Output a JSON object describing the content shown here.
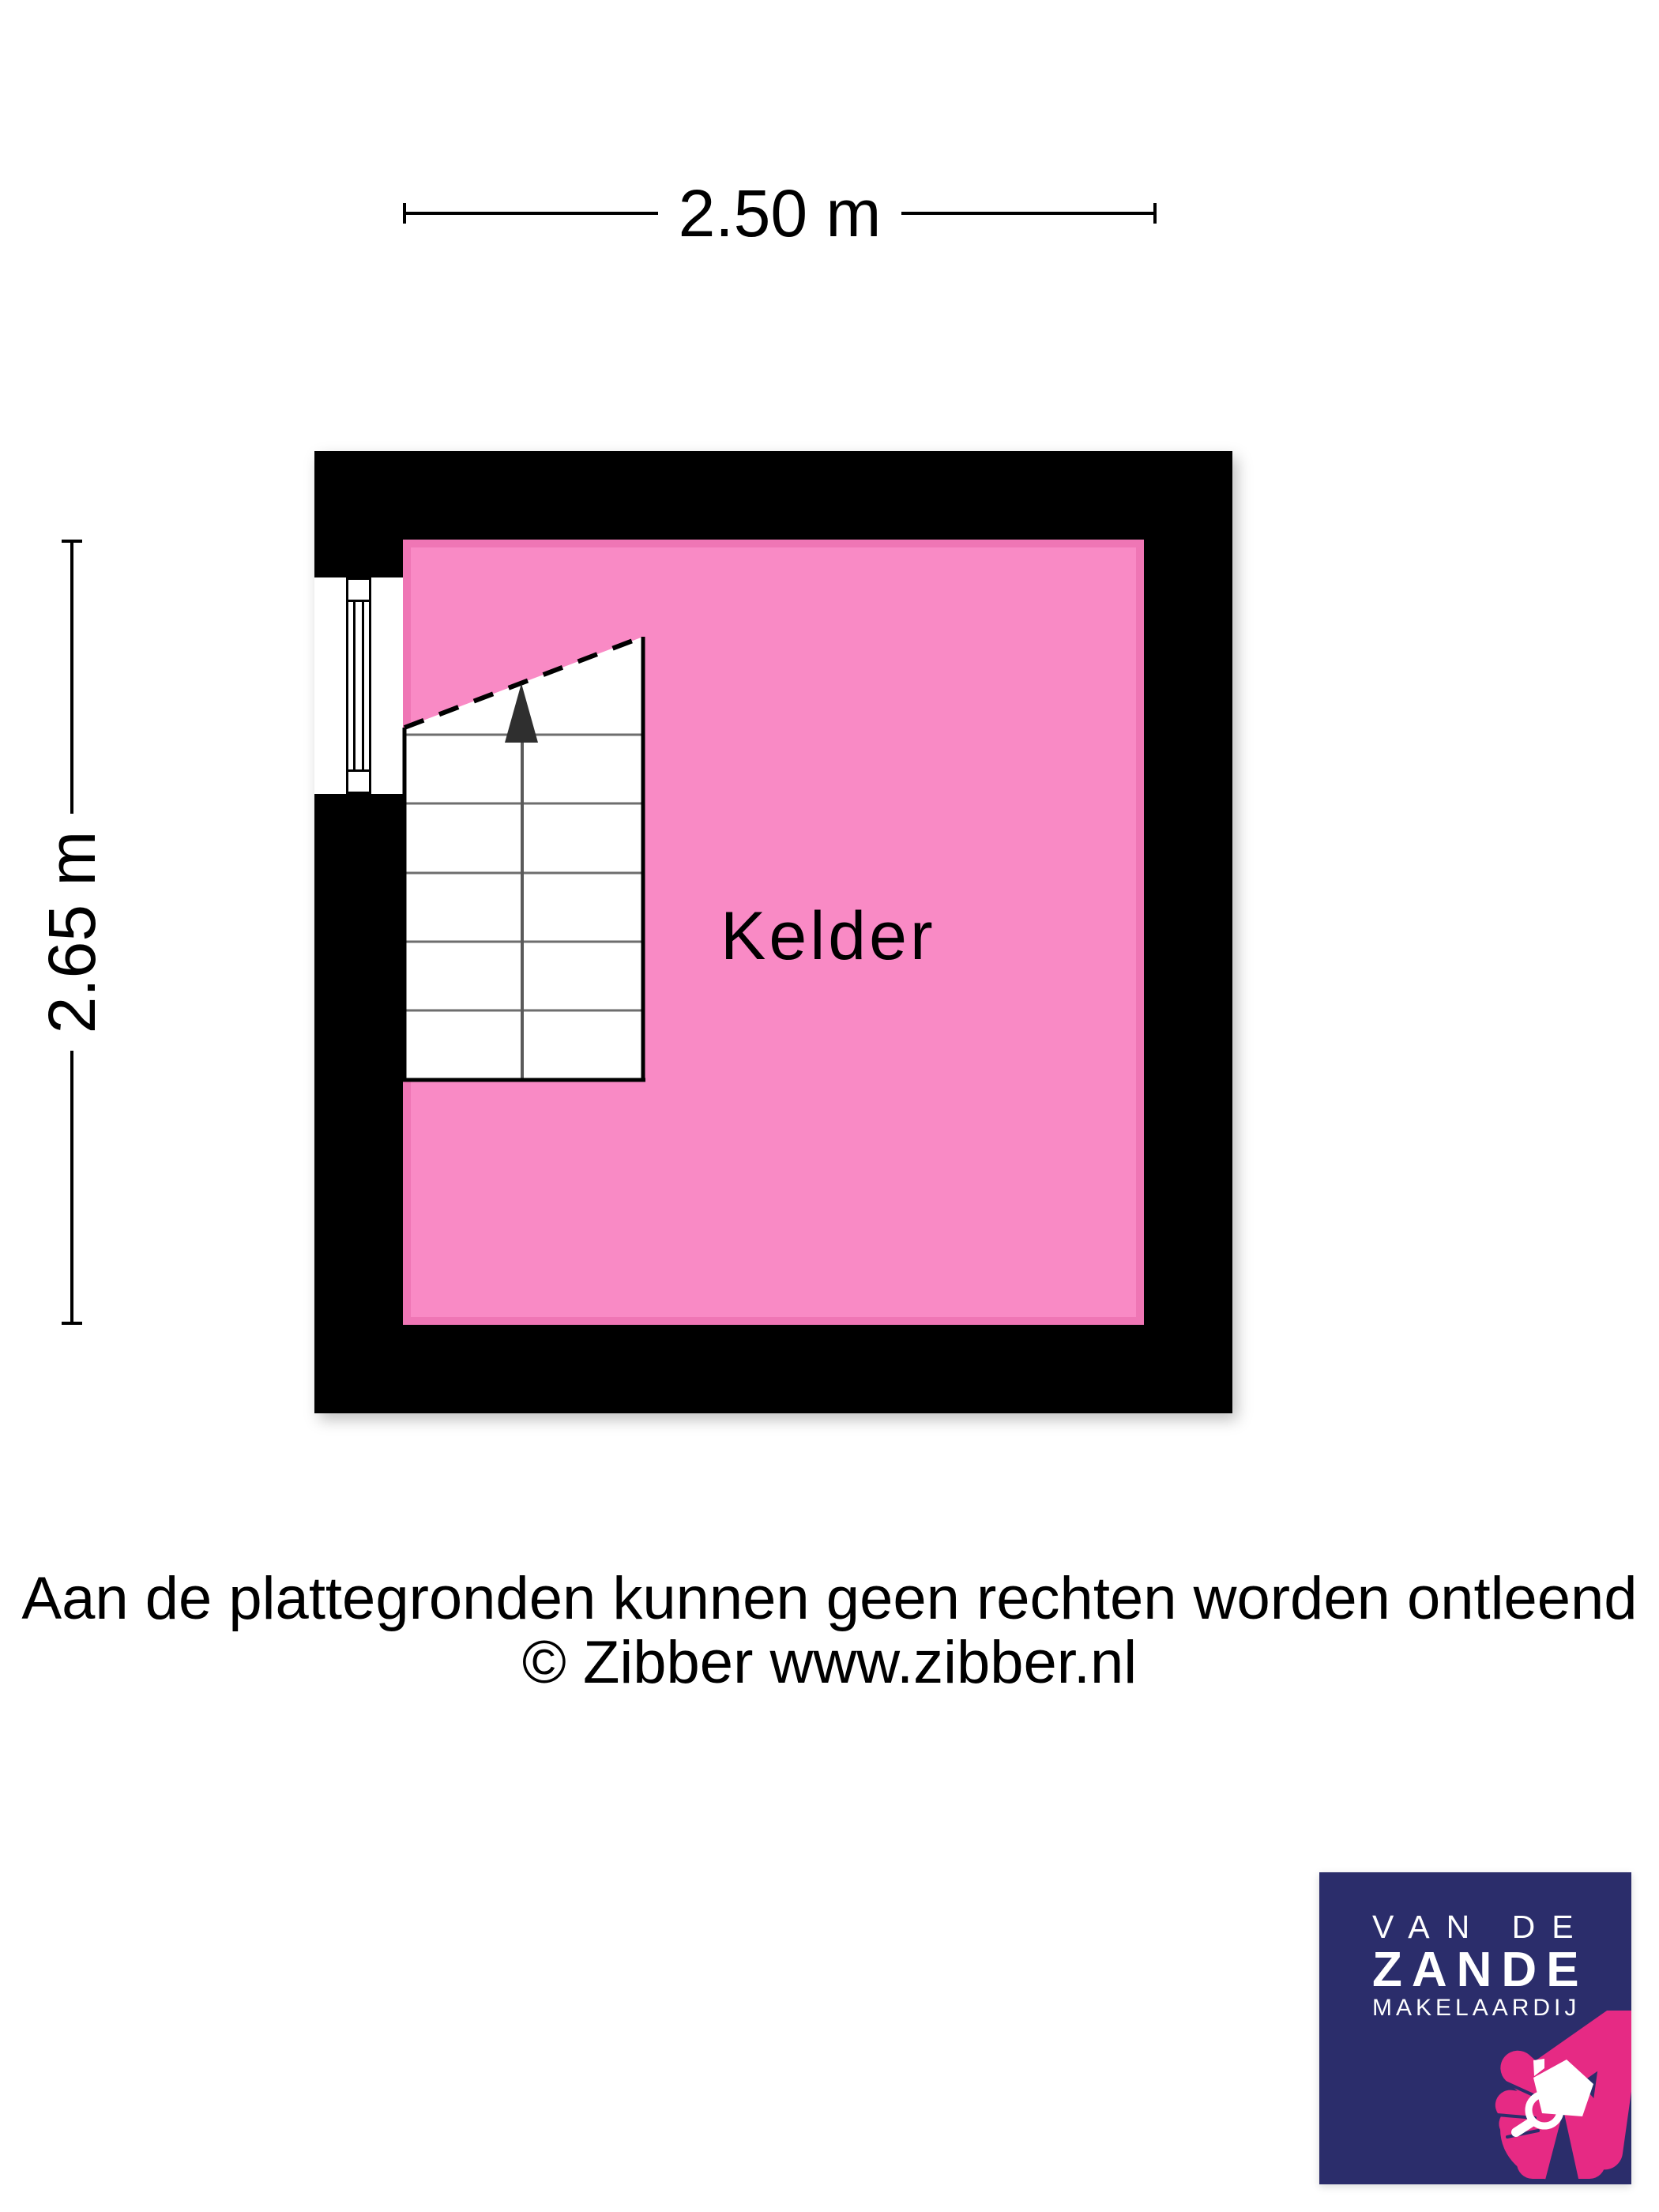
{
  "scale_bars": {
    "horizontal": {
      "label": "2.50 m"
    },
    "vertical": {
      "label": "2.65 m"
    }
  },
  "floor_plan": {
    "room": {
      "label": "Kelder"
    },
    "features": {
      "staircase": "stairs with up arrow and dashed headroom line",
      "window": "window in left wall"
    },
    "colors": {
      "wall": "#000000",
      "floor": "#f98ac5",
      "floor_edge": "#ef76b5",
      "stair_tread_line": "#6e6e6e",
      "stair_arrow": "#2f2f2f"
    }
  },
  "footer": {
    "disclaimer": "Aan de plattegronden kunnen geen rechten worden ontleend",
    "copyright": "© Zibber www.zibber.nl"
  },
  "logo": {
    "line_top": "VAN DE",
    "line_main": "ZANDE",
    "line_sub": "MAKELAARDIJ",
    "colors": {
      "background": "#2b2d6b",
      "pink": "#e62a84",
      "text": "#ffffff"
    }
  }
}
